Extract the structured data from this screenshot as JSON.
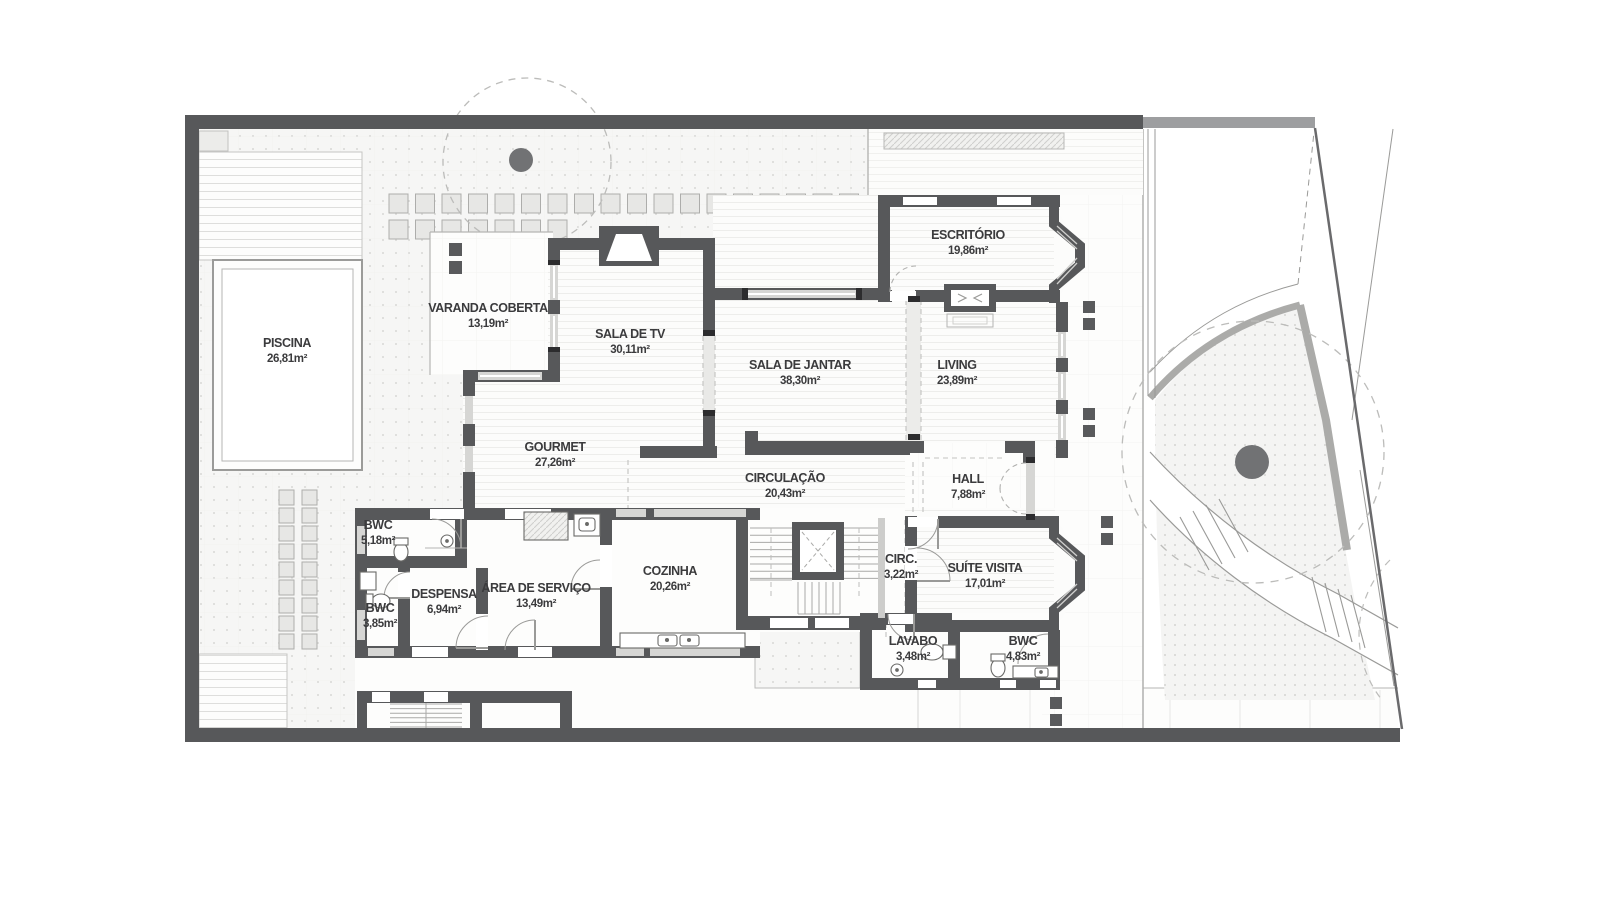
{
  "floorplan": {
    "rooms": [
      {
        "name": "PISCINA",
        "area": "26,81m²",
        "x": 287,
        "y": 347
      },
      {
        "name": "VARANDA COBERTA",
        "area": "13,19m²",
        "x": 488,
        "y": 312
      },
      {
        "name": "SALA DE TV",
        "area": "30,11m²",
        "x": 630,
        "y": 338
      },
      {
        "name": "ESCRITÓRIO",
        "area": "19,86m²",
        "x": 968,
        "y": 239
      },
      {
        "name": "SALA DE JANTAR",
        "area": "38,30m²",
        "x": 800,
        "y": 369
      },
      {
        "name": "LIVING",
        "area": "23,89m²",
        "x": 957,
        "y": 369
      },
      {
        "name": "GOURMET",
        "area": "27,26m²",
        "x": 555,
        "y": 451
      },
      {
        "name": "CIRCULAÇÃO",
        "area": "20,43m²",
        "x": 785,
        "y": 482
      },
      {
        "name": "HALL",
        "area": "7,88m²",
        "x": 968,
        "y": 483
      },
      {
        "name": "BWC",
        "area": "5,18m²",
        "x": 378,
        "y": 529
      },
      {
        "name": "BWC",
        "area": "3,85m²",
        "x": 380,
        "y": 612
      },
      {
        "name": "DESPENSA",
        "area": "6,94m²",
        "x": 444,
        "y": 598
      },
      {
        "name": "ÁREA DE SERVIÇO",
        "area": "13,49m²",
        "x": 536,
        "y": 592
      },
      {
        "name": "COZINHA",
        "area": "20,26m²",
        "x": 670,
        "y": 575
      },
      {
        "name": "CIRC.",
        "area": "3,22m²",
        "x": 901,
        "y": 563
      },
      {
        "name": "SUÍTE VISITA",
        "area": "17,01m²",
        "x": 985,
        "y": 572
      },
      {
        "name": "LAVABO",
        "area": "3,48m²",
        "x": 913,
        "y": 645
      },
      {
        "name": "BWC",
        "area": "4,83m²",
        "x": 1023,
        "y": 645
      }
    ],
    "colors": {
      "wall": "#57585a",
      "wall_light": "#9d9ea0",
      "text": "#3b3b3d",
      "window": "#d6d6d4",
      "paver": "#e7e7e5",
      "ground_dot": "#d8d8d6",
      "path_edge": "#ababa9",
      "tree_trunk": "#717274"
    },
    "icons": [
      "tree-icon",
      "fireplace-icon",
      "elevator-icon",
      "stairs-icon",
      "toilet-icon",
      "sink-icon",
      "pool-icon",
      "double-door-icon"
    ]
  }
}
